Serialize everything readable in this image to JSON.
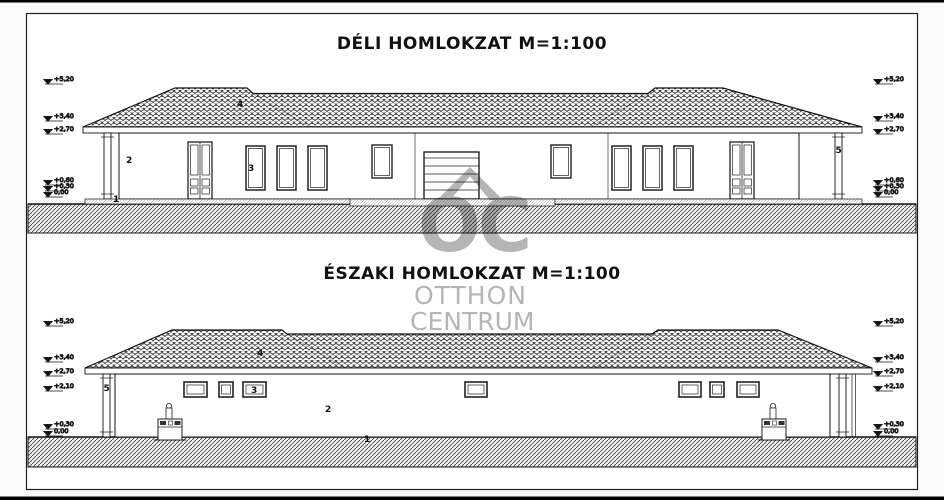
{
  "watermark": {
    "logo": "OC",
    "line1": "OTTHON",
    "line2": "CENTRUM"
  },
  "colors": {
    "line": "#1a1a1a",
    "watermark": "#b5b5b5",
    "paper": "#ffffff"
  },
  "elevations": [
    {
      "title": "DÉLI HOMLOKZAT M=1:100",
      "markers_left": [
        "+5,20",
        "+3,40",
        "+2,70",
        "+0,60",
        "+0,30",
        "0,00"
      ],
      "markers_right": [
        "+5,20",
        "+3,40",
        "+2,70",
        "+0,60",
        "+0,30",
        "0,00"
      ],
      "labels": [
        "1",
        "2",
        "3",
        "4",
        "5"
      ]
    },
    {
      "title": "ÉSZAKI HOMLOKZAT M=1:100",
      "markers_left": [
        "+5,20",
        "+3,40",
        "+2,70",
        "+2,10",
        "+0,30",
        "0,00"
      ],
      "markers_right": [
        "+5,20",
        "+3,40",
        "+2,70",
        "+2,10",
        "+0,30",
        "0,00"
      ],
      "labels": [
        "1",
        "2",
        "3",
        "4",
        "5"
      ]
    }
  ]
}
